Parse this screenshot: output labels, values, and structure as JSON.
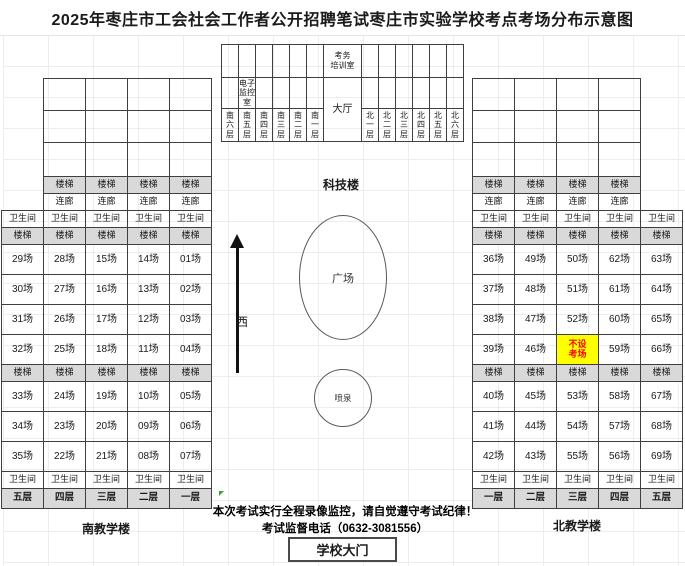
{
  "title": "2025年枣庄市工会社会工作者公开招聘笔试枣庄市实验学校考点考场分布示意图",
  "common": {
    "stairs": "楼梯",
    "corridor": "连廊",
    "restroom": "卫生间"
  },
  "south_building": {
    "caption": "南教学楼",
    "floors": [
      "五层",
      "四层",
      "三层",
      "二层",
      "一层"
    ],
    "rooms_upper": [
      [
        "29场",
        "28场",
        "15场",
        "14场",
        "01场"
      ],
      [
        "30场",
        "27场",
        "16场",
        "13场",
        "02场"
      ],
      [
        "31场",
        "26场",
        "17场",
        "12场",
        "03场"
      ],
      [
        "32场",
        "25场",
        "18场",
        "11场",
        "04场"
      ]
    ],
    "rooms_lower": [
      [
        "33场",
        "24场",
        "19场",
        "10场",
        "05场"
      ],
      [
        "34场",
        "23场",
        "20场",
        "09场",
        "06场"
      ],
      [
        "35场",
        "22场",
        "21场",
        "08场",
        "07场"
      ]
    ]
  },
  "north_building": {
    "caption": "北教学楼",
    "floors": [
      "一层",
      "二层",
      "三层",
      "四层",
      "五层"
    ],
    "rooms_upper": [
      [
        "36场",
        "49场",
        "50场",
        "62场",
        "63场"
      ],
      [
        "37场",
        "48场",
        "51场",
        "61场",
        "64场"
      ],
      [
        "38场",
        "47场",
        "52场",
        "60场",
        "65场"
      ],
      [
        "39场",
        "46场",
        "不设考场",
        "59场",
        "66场"
      ]
    ],
    "rooms_lower": [
      [
        "40场",
        "45场",
        "53场",
        "58场",
        "67场"
      ],
      [
        "41场",
        "44场",
        "54场",
        "57场",
        "68场"
      ],
      [
        "42场",
        "43场",
        "55场",
        "56场",
        "69场"
      ]
    ],
    "no_exam_room": {
      "row": 3,
      "col": 2,
      "label": "不设\n考场"
    }
  },
  "science_building": {
    "caption": "科技楼",
    "training_room": "考务\n培训室",
    "monitor_room": "电子\n监控\n室",
    "hall": "大厅",
    "south_wings": [
      "南六层",
      "南五层",
      "南四层",
      "南三层",
      "南二层",
      "南一层"
    ],
    "north_wings": [
      "北一层",
      "北二层",
      "北三层",
      "北四层",
      "北五层",
      "北六层"
    ]
  },
  "center_area": {
    "plaza": "广场",
    "fountain": "喷泉",
    "west": "西"
  },
  "notice": {
    "line1": "本次考试实行全程录像监控，请自觉遵守考试纪律！",
    "line2": "考试监督电话（0632-3081556）"
  },
  "gate_label": "学校大门",
  "colors": {
    "shaded": "#d9d9d9",
    "highlight_bg": "#ffff00",
    "highlight_text": "#ff0000",
    "border": "#3f3f3f"
  }
}
